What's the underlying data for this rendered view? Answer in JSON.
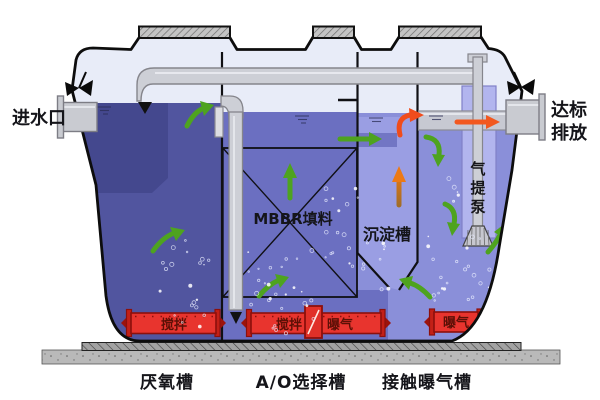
{
  "diagram": {
    "inlet": {
      "label": "进水口"
    },
    "outlet": {
      "line1": "达标",
      "line2": "排放"
    },
    "tanks": {
      "anaerobic": {
        "label": "厌氧槽",
        "water_color": "#51559f",
        "baffle_color": "#44488e"
      },
      "ao": {
        "label": "A/O选择槽",
        "water_color": "#6b6fc1",
        "under_color": "#6b6fc1"
      },
      "contact": {
        "label": "接触曝气槽",
        "water_color": "#8a8fd9"
      },
      "settling": {
        "label": "沉淀槽",
        "water_color": "#9a9ee3",
        "inlet_band_color": "#7276c4"
      }
    },
    "mbbr": {
      "label": "MBBR填料"
    },
    "airlift": {
      "label": "气提泵",
      "chars": [
        "气",
        "提",
        "泵"
      ],
      "chamber_color": "#b2b5ee"
    },
    "equipment": {
      "color": "#e8342e",
      "anaerobic_mixer": {
        "label": "搅拌"
      },
      "ao_mixer": {
        "label": "搅拌"
      },
      "ao_aerator": {
        "label": "曝气"
      },
      "contact_aerator": {
        "label": "曝气"
      }
    },
    "flow_colors": {
      "green": "#4ea31f",
      "orange": "#ec7a16",
      "red": "#f04c1c"
    },
    "freeboard_color": "#e8ecf8"
  }
}
